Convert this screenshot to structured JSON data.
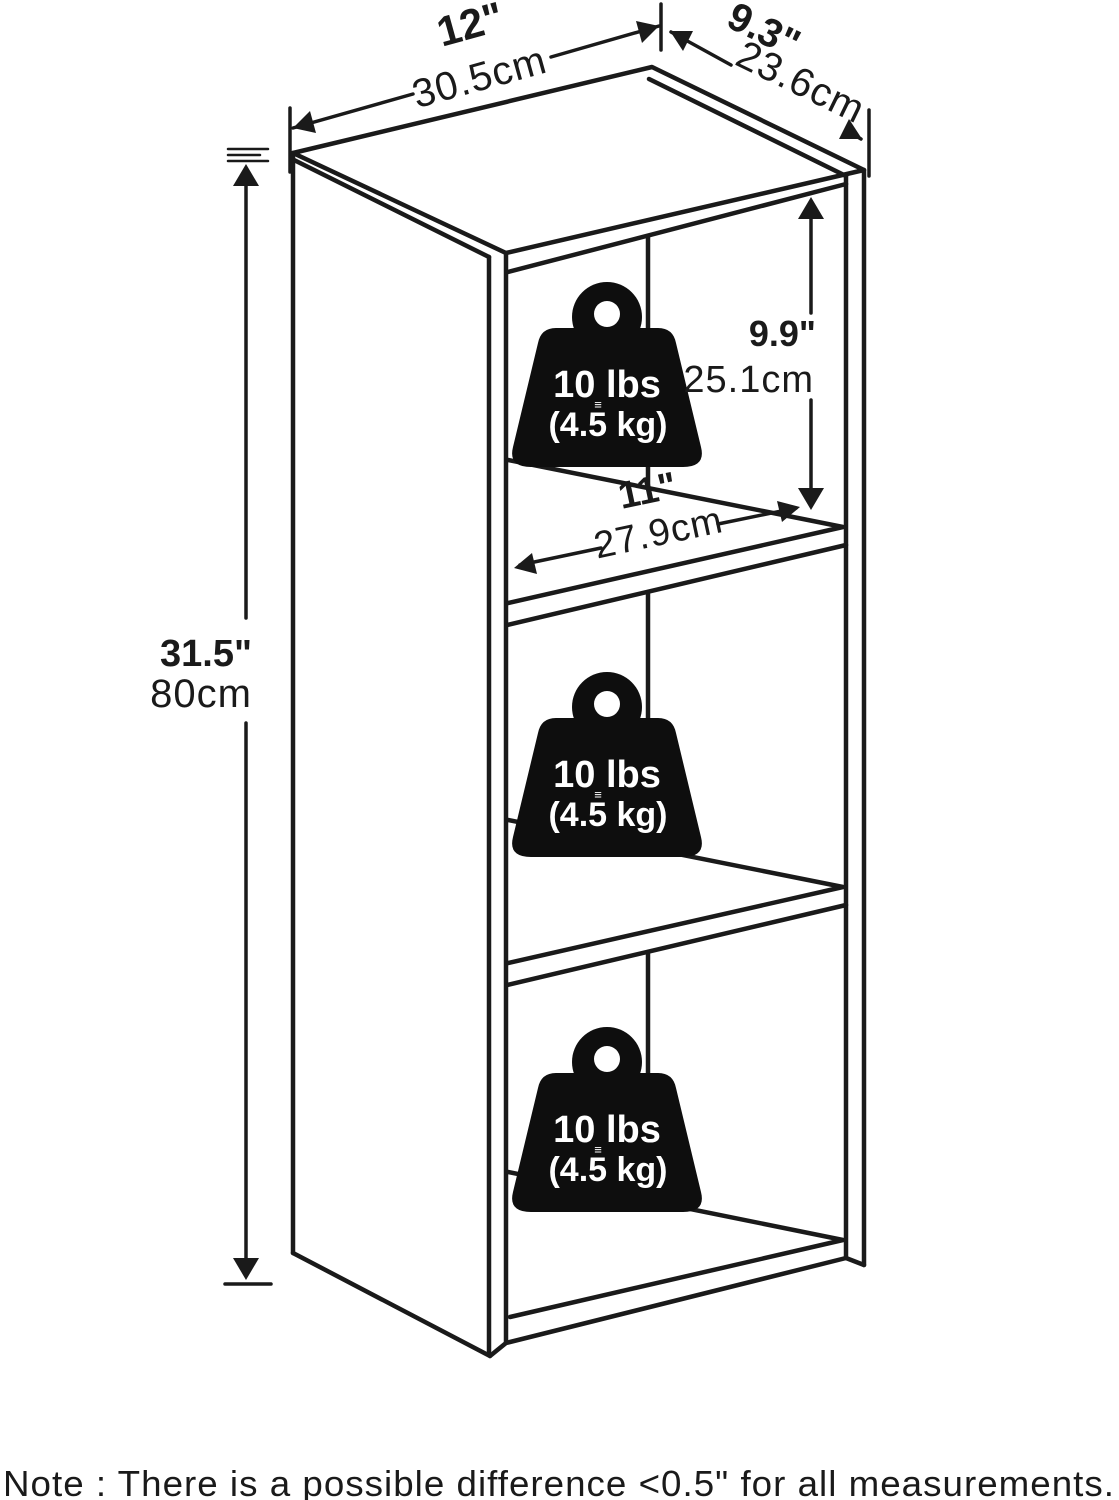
{
  "diagram": {
    "dims": {
      "width": {
        "inches": "12\"",
        "cm": "30.5cm"
      },
      "depth": {
        "inches": "9.3\"",
        "cm": "23.6cm"
      },
      "height": {
        "inches": "31.5\"",
        "cm": "80cm"
      },
      "shelf_height": {
        "inches": "9.9\"",
        "cm": "25.1cm"
      },
      "shelf_width": {
        "inches": "11\"",
        "cm": "27.9cm"
      }
    },
    "weights": [
      {
        "lbs": "10 lbs",
        "kg": "(4.5 kg)",
        "mark": "≡"
      },
      {
        "lbs": "10 lbs",
        "kg": "(4.5 kg)",
        "mark": "≡"
      },
      {
        "lbs": "10 lbs",
        "kg": "(4.5 kg)",
        "mark": "≡"
      }
    ],
    "note": "Note : There is a possible difference <0.5\" for all measurements."
  }
}
